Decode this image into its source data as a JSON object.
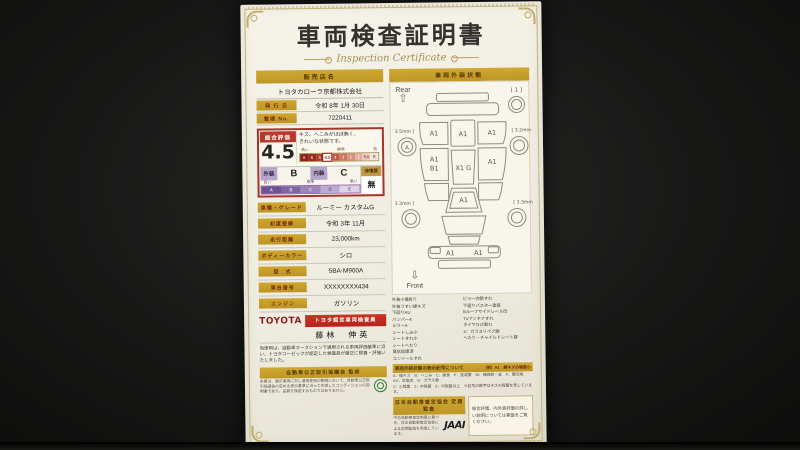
{
  "title": "車両検査証明書",
  "subtitle": "Inspection Certificate",
  "left": {
    "dealer_header": "販売店名",
    "dealer_name": "トヨタカローラ京都株式会社",
    "issue_label": "発 行 日",
    "issue_value": "令和 8年 1月 30日",
    "ref_label": "整理 No.",
    "ref_value": "7220411",
    "rating": {
      "header": "総合評価",
      "score": "4.5",
      "note1": "キズ、へこみがほぼ無く、",
      "note2": "きれいな状態です。",
      "scale_hi": "高い",
      "scale_mid": "標準",
      "scale_lo": "低",
      "scale": [
        "S",
        "6",
        "5",
        "4.5",
        "4",
        "3",
        "2",
        "1",
        "RA",
        "R"
      ],
      "ext_label": "外装",
      "ext_value": "B",
      "int_label": "内装",
      "int_value": "C",
      "repair_label": "修復歴",
      "repair_value": "無",
      "grade_hi": "良い",
      "grade_mid": "標準",
      "grade_lo": "悪い",
      "grade_scale": [
        "A",
        "B",
        "C",
        "D",
        "E"
      ]
    },
    "specs": [
      {
        "label": "車種・グレード",
        "value": "ルーミー カスタムG"
      },
      {
        "label": "初度登録",
        "value": "令和 3年 11月"
      },
      {
        "label": "走行距離",
        "value": "23,000km"
      },
      {
        "label": "ボディーカラー",
        "value": "シロ"
      },
      {
        "label": "型　式",
        "value": "5BA-M900A"
      },
      {
        "label": "車台番号",
        "value": "XXXXXXXX434"
      },
      {
        "label": "エンジン",
        "value": "ガソリン"
      }
    ],
    "toyota_logo": "TOYOTA",
    "inspector_banner": "トヨタ認定車両検査員",
    "inspector_name": "藤林　伸英",
    "disclaimer": "当車両は、自動車オークションで通用される車両評価基準に沿い、トヨタユーゼックが認定した検査員が厳正に検査・評価いたしました。",
    "fair_trade_banner": "自動車公正取引協議会 監修",
    "fair_trade_note": "本書は、展示車両に対し通常使用の範囲において、自動車公正取引協議会の定める表示基準に沿って作成したコンディションの説明書であり、品質を保証するものではありません。"
  },
  "right": {
    "header": "車両外装状態",
    "diagram": {
      "rear_label": "Rear",
      "front_label": "Front",
      "rear_arrow": "⇧",
      "front_arrow": "⇩",
      "spare_label": "[ 1 ]",
      "wheel_rear_left": "[ 3.5mm ]",
      "wheel_rear_right": "[ 3.2mm ]",
      "wheel_front_left": "[ 3.3mm ]",
      "wheel_front_right": "[ 3.3mm ]",
      "wheel_mark": "A",
      "left_quarter": "A1",
      "rear_gate": "A1",
      "right_quarter": "A1",
      "left_door": "A1",
      "left_small": "B1",
      "right_door": "A1",
      "roof": "X1 G",
      "windshield": "A1",
      "bumper_left": "A1",
      "bumper_right": "A1"
    },
    "legend_left": [
      "外装小傷有り",
      "外装うすい線キズ",
      "下回りAU",
      "バンパーA",
      "ミラーA",
      "シートしみ小",
      "シートすれ小",
      "シートへたり",
      "臭気処理済",
      "コンソールすれ"
    ],
    "legend_right": [
      "ピラー内張すれ",
      "下廻りバスター塗装",
      "Bルーフサイドレール凹",
      "TVアンテナすれ",
      "タイヤひび割れ",
      "X：ガラスリペア跡",
      "へたり・チャイルドシート跡"
    ],
    "symbol_banner": "車両外装状態の表示記号について",
    "symbol_example": "（例）A1　線キズの程度小",
    "symbol_note1": "A：線キズ　B：へこみ　C：腐食　P：塗装要　W：補修跡・波　X：要交換　XX：交換済　G：ガラス傷",
    "symbol_note2": "1：小程度　2：中程度　3：中程度以上　※記号の数字はキズの程度を表しています。",
    "jaai_banner": "日本自動車査定協会 定期監査",
    "jaai_note": "中古自動車査定制度に基づき、日本自動車査定協会による定期監査を実施しています。",
    "jaai_logo": "JAAI",
    "back_note": "総合評価、内外装評価の詳しい説明については裏面をご覧ください。"
  }
}
